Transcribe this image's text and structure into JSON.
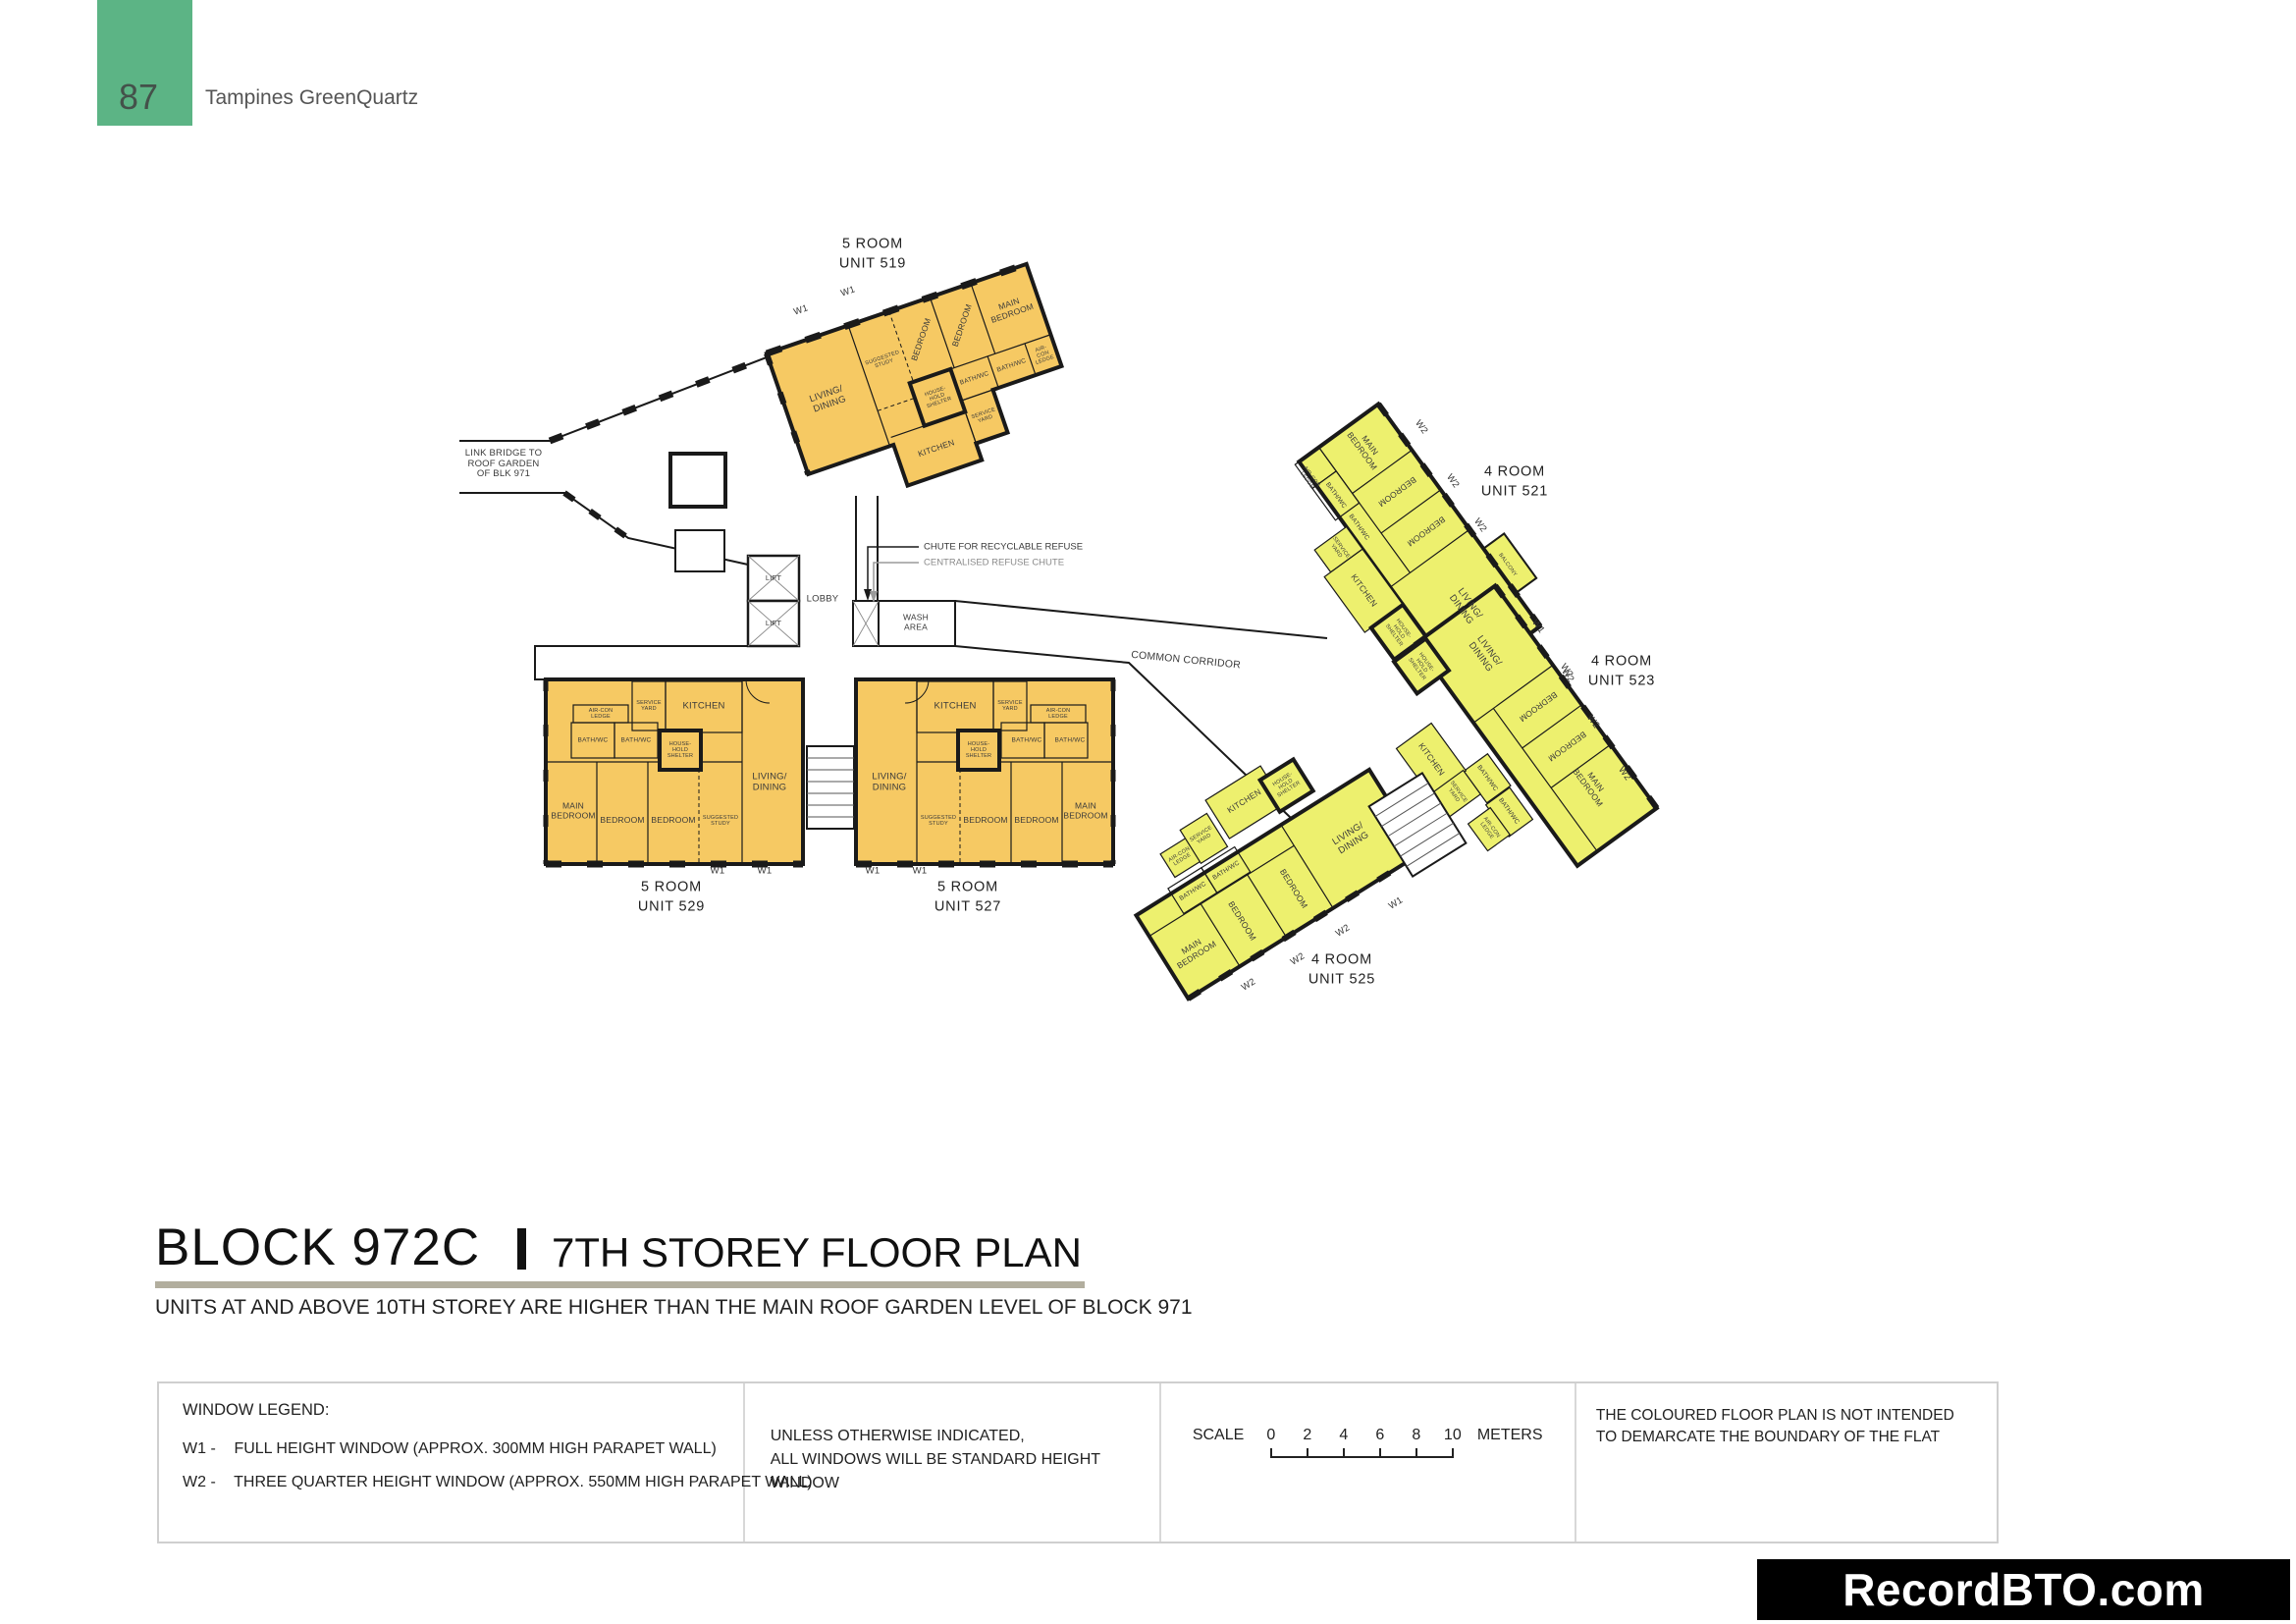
{
  "page_header": {
    "page_number": "87",
    "project_name": "Tampines GreenQuartz"
  },
  "title_block": {
    "block": "BLOCK 972C",
    "storey": "7TH STOREY FLOOR PLAN",
    "note": "UNITS AT AND ABOVE 10TH STOREY ARE HIGHER THAN THE MAIN ROOF GARDEN LEVEL OF BLOCK 971"
  },
  "colors": {
    "five_room_fill": "#F6C963",
    "four_room_fill": "#EDF06E",
    "header_green": "#5CB485",
    "wall": "#1A1A1A",
    "title_rule": "#B2AE9E"
  },
  "plan": {
    "annotations": {
      "link_bridge": "LINK BRIDGE TO\nROOF GARDEN\nOF BLK 971",
      "chute_recyclable": "CHUTE FOR RECYCLABLE REFUSE",
      "chute_centralised": "CENTRALISED REFUSE CHUTE",
      "lift": "LIFT",
      "lobby": "LOBBY",
      "wash_area": "WASH\nAREA",
      "common_corridor": "COMMON CORRIDOR"
    },
    "units": {
      "u519": {
        "type": "5 ROOM",
        "unit": "UNIT 519",
        "windows": [
          "W1",
          "W1"
        ],
        "rooms": {
          "living": "LIVING/\nDINING",
          "study": "SUGGESTED\nSTUDY",
          "bedroom1": "BEDROOM",
          "bedroom2": "BEDROOM",
          "main_bedroom": "MAIN\nBEDROOM",
          "bath1": "BATH/WC",
          "bath2": "BATH/WC",
          "aircon": "AIR-CON\nLEDGE",
          "shelter": "HOUSE-\nHOLD\nSHELTER",
          "service": "SERVICE\nYARD",
          "kitchen": "KITCHEN"
        }
      },
      "u529": {
        "type": "5 ROOM",
        "unit": "UNIT 529",
        "windows": [
          "W1",
          "W1"
        ],
        "rooms": {
          "aircon": "AIR-CON\nLEDGE",
          "service": "SERVICE\nYARD",
          "kitchen": "KITCHEN",
          "living": "LIVING/\nDINING",
          "bath1": "BATH/WC",
          "bath2": "BATH/WC",
          "shelter": "HOUSE-\nHOLD\nSHELTER",
          "main_bedroom": "MAIN\nBEDROOM",
          "bedroom1": "BEDROOM",
          "bedroom2": "BEDROOM",
          "study": "SUGGESTED\nSTUDY"
        }
      },
      "u527": {
        "type": "5 ROOM",
        "unit": "UNIT 527",
        "windows": [
          "W1",
          "W1"
        ],
        "rooms": {
          "kitchen": "KITCHEN",
          "service": "SERVICE\nYARD",
          "aircon": "AIR-CON\nLEDGE",
          "living": "LIVING/\nDINING",
          "shelter": "HOUSE-\nHOLD\nSHELTER",
          "bath1": "BATH/WC",
          "bath2": "BATH/WC",
          "study": "SUGGESTED\nSTUDY",
          "bedroom1": "BEDROOM",
          "bedroom2": "BEDROOM",
          "main_bedroom": "MAIN\nBEDROOM"
        }
      },
      "u521": {
        "type": "4 ROOM",
        "unit": "UNIT 521",
        "windows": [
          "W2",
          "W2",
          "W2",
          "W1",
          "W2"
        ],
        "rooms": {
          "main_bedroom": "MAIN\nBEDROOM",
          "bedroom1": "BEDROOM",
          "bedroom2": "BEDROOM",
          "living": "LIVING/\nDINING",
          "bath1": "BATH/WC",
          "bath2": "BATH/WC",
          "aircon": "AIR-CON\nLEDGE",
          "service": "SERVICE\nYARD",
          "kitchen": "KITCHEN",
          "shelter": "HOUSE-\nHOLD\nSHELTER",
          "balcony": "BALCONY"
        }
      },
      "u523": {
        "type": "4 ROOM",
        "unit": "UNIT 523",
        "windows": [
          "W2",
          "W2",
          "W2"
        ],
        "rooms": {
          "living": "LIVING/\nDINING",
          "bedroom1": "BEDROOM",
          "bedroom2": "BEDROOM",
          "main_bedroom": "MAIN\nBEDROOM",
          "bath1": "BATH/WC",
          "bath2": "BATH/WC",
          "kitchen": "KITCHEN",
          "service": "SERVICE\nYARD",
          "aircon": "AIR-CON\nLEDGE",
          "shelter": "HOUSE-\nHOLD\nSHELTER"
        }
      },
      "u525": {
        "type": "4 ROOM",
        "unit": "UNIT 525",
        "windows": [
          "W2",
          "W2",
          "W2",
          "W1"
        ],
        "rooms": {
          "kitchen": "KITCHEN",
          "service": "SERVICE\nYARD",
          "shelter": "HOUSE-\nHOLD\nSHELTER",
          "aircon": "AIR-CON\nLEDGE",
          "bath1": "BATH/WC",
          "bath2": "BATH/WC",
          "main_bedroom": "MAIN\nBEDROOM",
          "bedroom1": "BEDROOM",
          "bedroom2": "BEDROOM",
          "living": "LIVING/\nDINING"
        }
      }
    }
  },
  "legend": {
    "window_legend_title": "WINDOW LEGEND:",
    "items": [
      {
        "code": "W1 -",
        "desc": "FULL HEIGHT WINDOW (APPROX. 300MM HIGH PARAPET WALL)"
      },
      {
        "code": "W2 -",
        "desc": "THREE QUARTER HEIGHT WINDOW (APPROX. 550MM HIGH PARAPET WALL)"
      }
    ],
    "windows_note": "UNLESS OTHERWISE INDICATED,\nALL WINDOWS WILL BE STANDARD HEIGHT WINDOW",
    "scale": {
      "label": "SCALE",
      "ticks": [
        "0",
        "2",
        "4",
        "6",
        "8",
        "10"
      ],
      "unit": "METERS"
    },
    "boundary_note": "THE COLOURED FLOOR PLAN IS NOT INTENDED\nTO DEMARCATE THE BOUNDARY OF THE FLAT"
  },
  "watermark": "RecordBTO.com"
}
